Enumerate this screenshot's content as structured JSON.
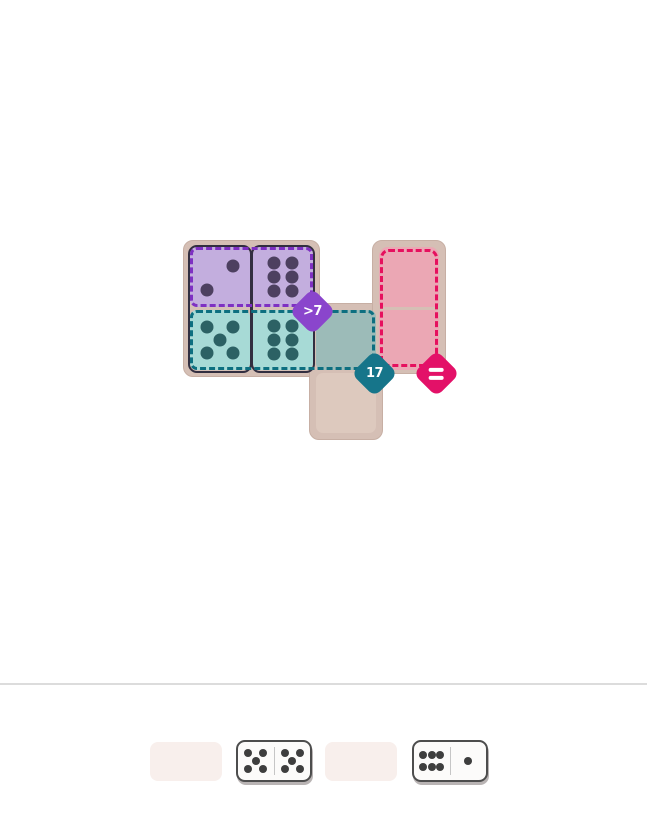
{
  "board": {
    "regions": [
      {
        "name": "purple",
        "constraint": ">7",
        "meaning": "sum greater than 7",
        "badge_color": "#8a45cc",
        "fill": "#c3aede",
        "dash": "#7e30c2"
      },
      {
        "name": "teal",
        "constraint": "17",
        "meaning": "sum equals 17",
        "badge_color": "#16758a",
        "fill": "#a7dad6",
        "dash": "#0d6f80"
      },
      {
        "name": "pink",
        "constraint": "=",
        "meaning": "cells equal",
        "badge_color": "#e31168",
        "fill": "#eba7b4",
        "dash": "#e6105e"
      }
    ],
    "cells": {
      "r1c1": {
        "pips": 2,
        "region": "purple"
      },
      "r1c2": {
        "pips": 6,
        "region": "purple"
      },
      "r2c1": {
        "pips": 5,
        "region": "teal"
      },
      "r2c2": {
        "pips": 6,
        "region": "teal"
      },
      "r2c3": {
        "pips": 0,
        "region": "teal"
      },
      "r3c3": {
        "pips": 0,
        "region": "none"
      },
      "r1c4": {
        "pips": 0,
        "region": "pink"
      },
      "r2c4": {
        "pips": 0,
        "region": "pink"
      }
    },
    "placed_dominoes": [
      {
        "orientation": "vertical",
        "top_pips": 2,
        "bottom_pips": 5
      },
      {
        "orientation": "vertical",
        "top_pips": 6,
        "bottom_pips": 6
      }
    ]
  },
  "badges": {
    "purple": ">7",
    "teal": "17",
    "pink": "="
  },
  "tray": {
    "slots": [
      {
        "type": "empty"
      },
      {
        "type": "domino",
        "left_pips": 5,
        "right_pips": 5
      },
      {
        "type": "empty"
      },
      {
        "type": "domino",
        "left_pips": 6,
        "right_pips": 1
      }
    ]
  },
  "colors": {
    "page_background": "#ffffff",
    "board_backing": "#d5bfb5",
    "empty_cell": "#ddc9be",
    "empty_teal_cell": "#9cbbb8",
    "purple_pip": "#4d4060",
    "teal_pip": "#2c6164",
    "domino_outline": "#322e40",
    "tray_slot": "#f8efec",
    "tray_domino_background": "#fcfbfa",
    "tray_domino_border": "#4d4d4d",
    "tray_pip": "#3e3e3e",
    "divider_line": "#dcdcdc"
  }
}
